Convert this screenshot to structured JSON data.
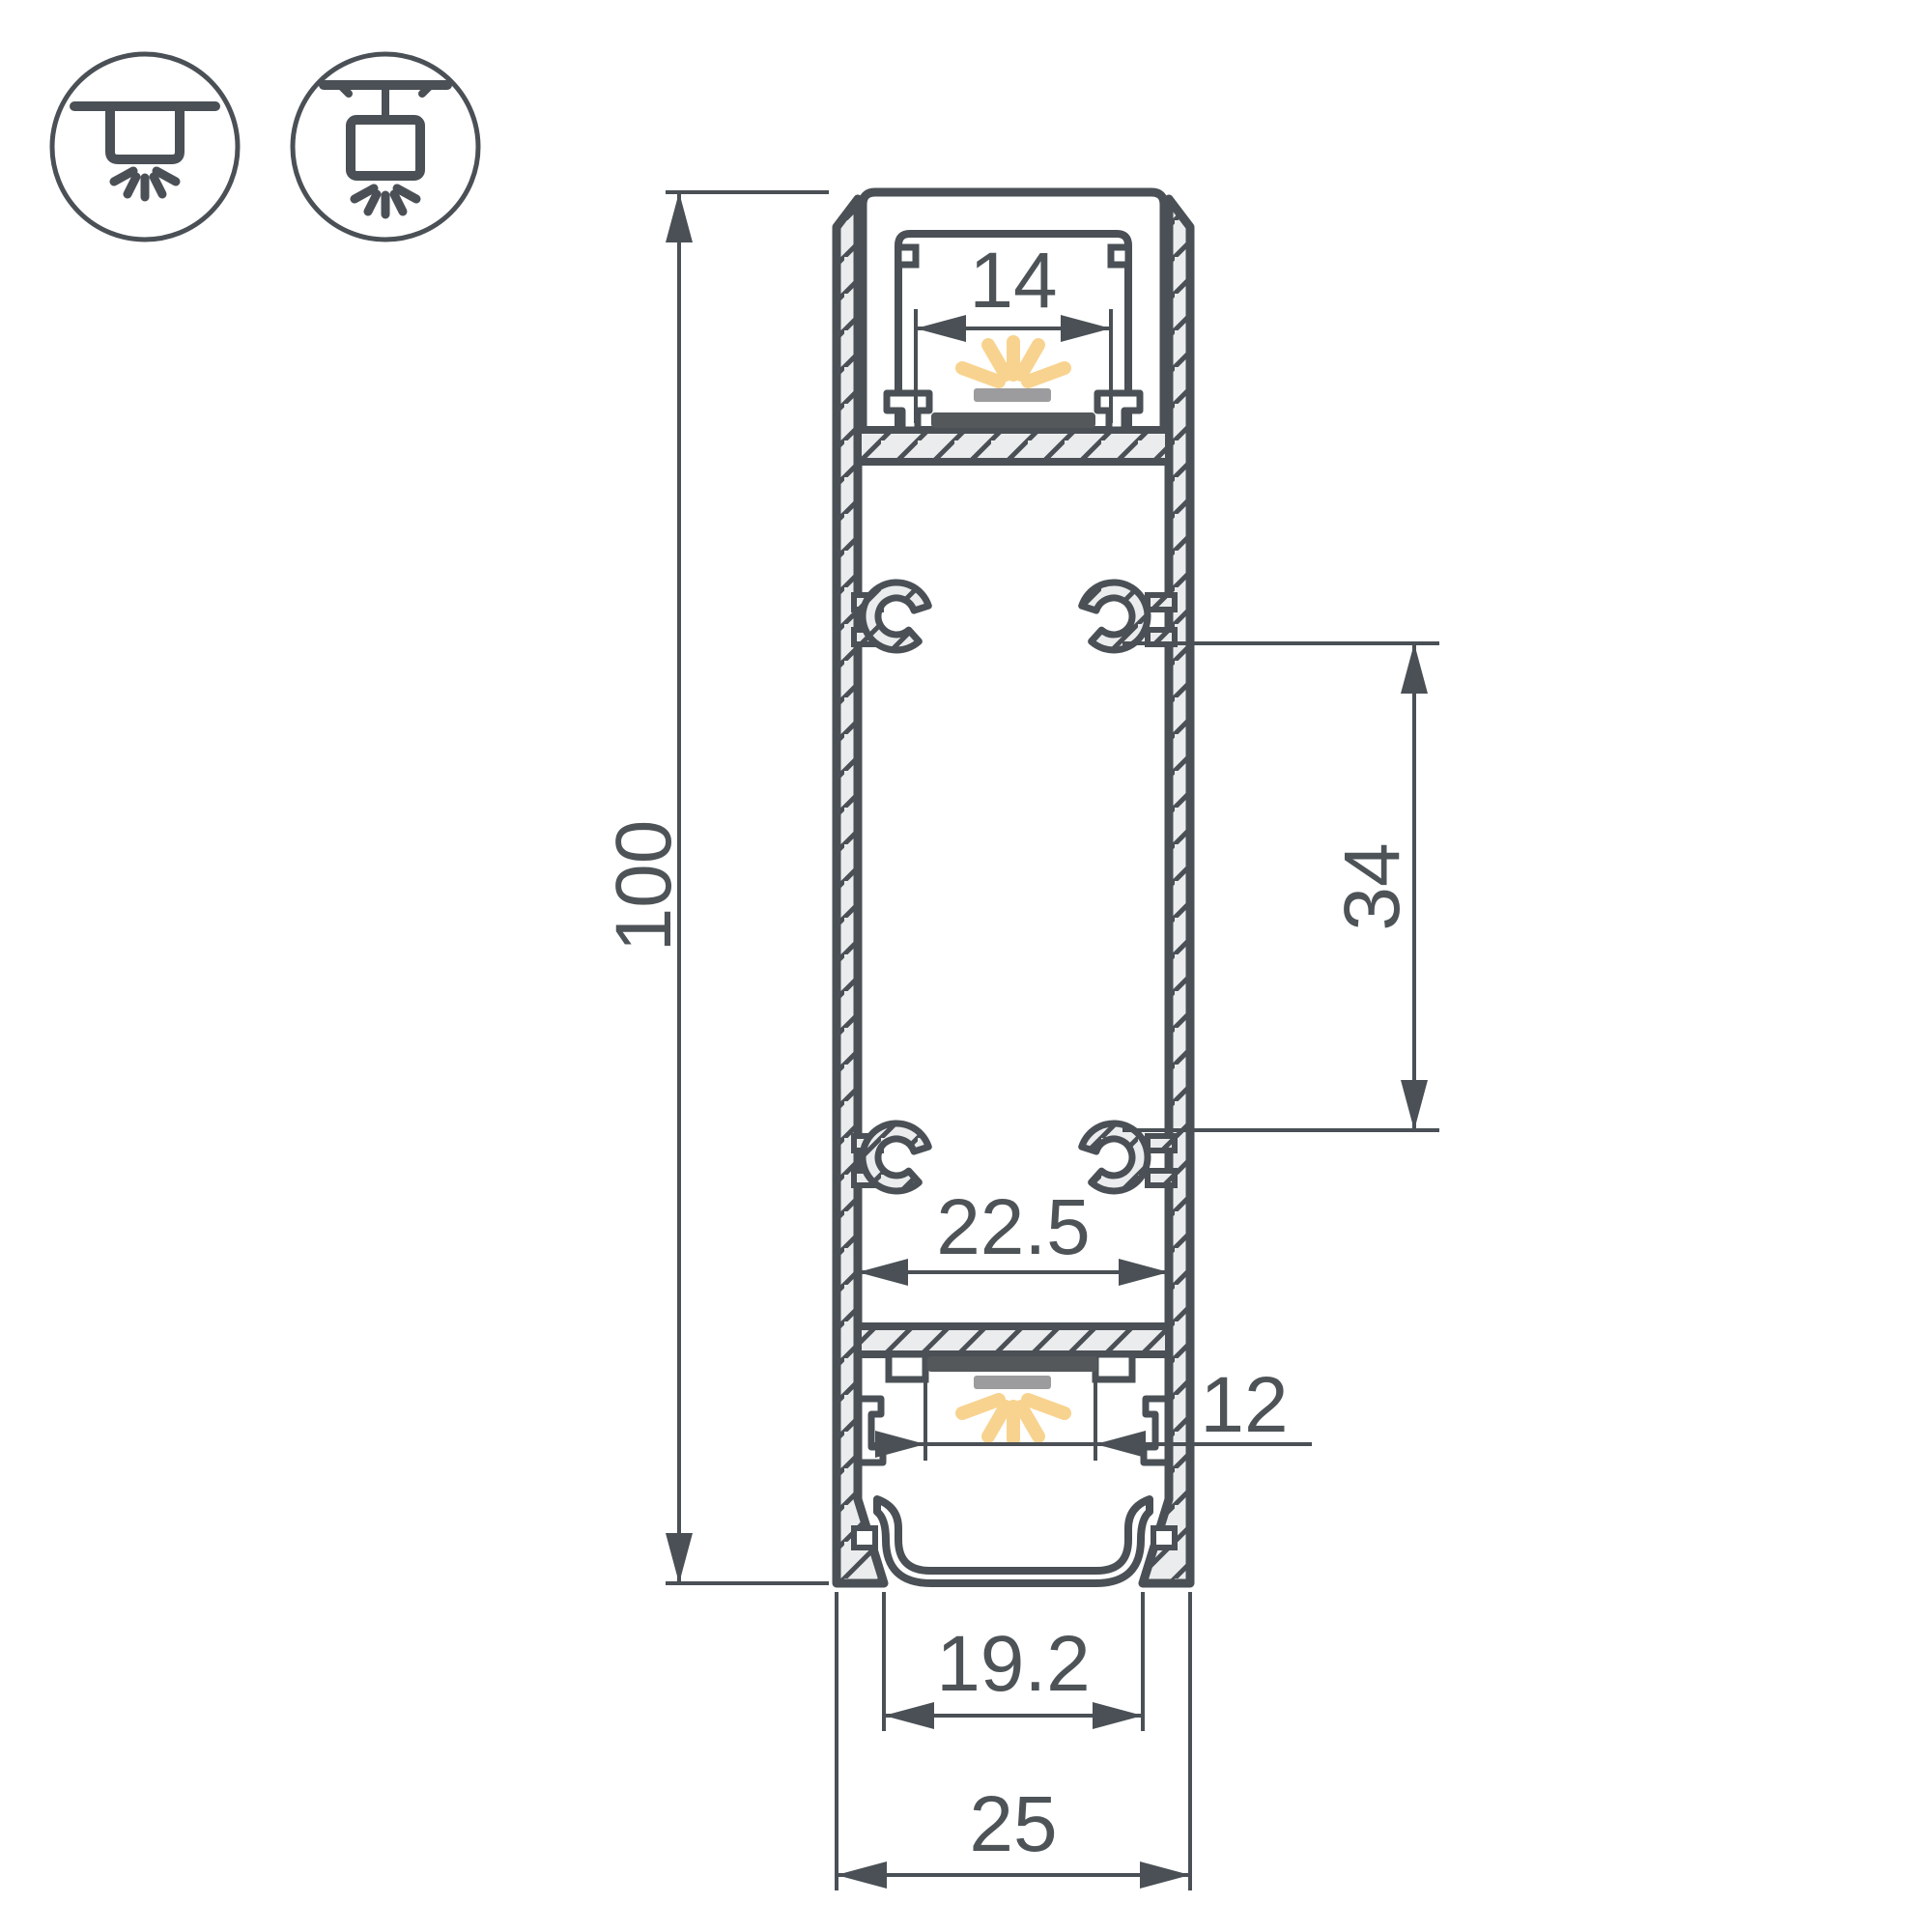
{
  "drawing": {
    "title": "LED profile cross-section technical drawing",
    "dimensions": {
      "overall_height": "100",
      "overall_width": "25",
      "top_led_opening": "14",
      "mount_boss_spacing": "34",
      "inner_cavity_width": "22.5",
      "bottom_led_opening": "12",
      "bottom_opening_width": "19.2"
    },
    "icons": [
      {
        "name": "surface-mount-icon",
        "meaning": "surface ceiling mount, light down"
      },
      {
        "name": "pendant-mount-icon",
        "meaning": "suspended pendant mount, light down"
      }
    ],
    "colors": {
      "outline": "#4a5055",
      "hatch_fill": "#ebeced",
      "light_rays": "#f8d38f",
      "led_bar": "#9c9c9e",
      "led_strip": "#54585b",
      "dimension_text": "#4d5357"
    }
  }
}
